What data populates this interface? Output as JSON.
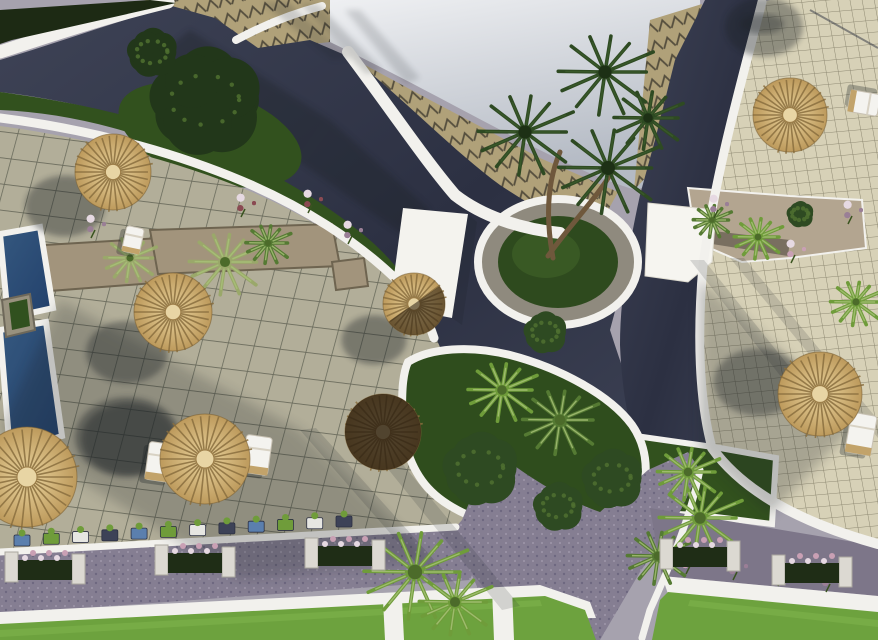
{
  "scene": {
    "description": "Aerial top-down 3D architectural rendering of a resort courtyard: dark blue-grey roads, beige tiled terraces with grid pavers, zigzag-patterned plaza, swimming pool at left edge, round and rectangular green planters with palm trees, straw parasols with sun loungers, white curved boundary walls, flower planter rows along a lower walkway and bright green lawns at the bottom",
    "sunlight": "hard daylight; soft shadows cast toward the lower left",
    "palette": {
      "roof1": "#f2f3f5",
      "roof2": "#b4bac4",
      "roadDark": "#3e4356",
      "roadDarker": "#2c3042",
      "roadLight": "#8a8496",
      "walkway": "#857e92",
      "gravel": "#7d7689",
      "zigBase": "#b0a179",
      "zigLine": "#564f3e",
      "terraceL": "#b2ae99",
      "terraceR": "#d7d1b7",
      "gridL": "#2d3228",
      "gridR": "#46422e",
      "white": "#f2f1ed",
      "grassDark": "#32511e",
      "lawn": "#6da23e",
      "lawnLight": "#7fb24c",
      "pool1": "#35587f",
      "pool2": "#22406b",
      "straw1": "#ead49e",
      "straw2": "#bd9a5c",
      "strawLine": "#8a6f3f",
      "palmDark": "#2e4a22",
      "palmMid": "#557a33",
      "palmLight": "#6f9c3a",
      "palmSage": "#9aa86a",
      "treeDark": "#22371a",
      "trunk": "#6f583c",
      "stone": "#a2947c",
      "flowerPink": "#c9a0b4",
      "flowerMauve": "#9a7f96",
      "flowerRed": "#8a4a52",
      "shadow": "#1c2026"
    }
  },
  "objects": {
    "parasols": [
      {
        "id": "parasol-1",
        "x": 113,
        "y": 172,
        "r": 38,
        "variant": "straw",
        "shadow": {
          "dx": -48,
          "dy": 34
        }
      },
      {
        "id": "parasol-2",
        "x": 27,
        "y": 477,
        "r": 50,
        "variant": "straw",
        "shadow": {
          "dx": 100,
          "dy": -40
        }
      },
      {
        "id": "parasol-3",
        "x": 173,
        "y": 312,
        "r": 39,
        "variant": "straw",
        "shadow": {
          "dx": -46,
          "dy": 40
        }
      },
      {
        "id": "parasol-4",
        "x": 205,
        "y": 459,
        "r": 45,
        "variant": "straw",
        "shadow": {
          "dx": -76,
          "dy": -20
        }
      },
      {
        "id": "parasol-5",
        "x": 383,
        "y": 432,
        "r": 38,
        "variant": "dark",
        "shadow": {
          "dx": 0,
          "dy": 0
        }
      },
      {
        "id": "parasol-6",
        "x": 414,
        "y": 304,
        "r": 31,
        "variant": "halfdark",
        "shadow": {
          "dx": -40,
          "dy": 36
        }
      },
      {
        "id": "parasol-7",
        "x": 790,
        "y": 115,
        "r": 37,
        "variant": "straw",
        "shadow": {
          "dx": -26,
          "dy": -88
        }
      },
      {
        "id": "parasol-8",
        "x": 820,
        "y": 394,
        "r": 42,
        "variant": "straw",
        "shadow": {
          "dx": -62,
          "dy": -12
        }
      }
    ],
    "loungers": [
      {
        "x": 160,
        "y": 462,
        "w": 26,
        "h": 38,
        "rot": 8
      },
      {
        "x": 257,
        "y": 455,
        "w": 26,
        "h": 38,
        "rot": 8
      },
      {
        "x": 861,
        "y": 434,
        "w": 26,
        "h": 40,
        "rot": 10
      },
      {
        "x": 864,
        "y": 103,
        "w": 22,
        "h": 30,
        "rot": 100
      },
      {
        "x": 133,
        "y": 240,
        "w": 18,
        "h": 26,
        "rot": 12
      },
      {
        "x": 12,
        "y": 495,
        "w": 18,
        "h": 28,
        "rot": 10
      }
    ],
    "palm_trees": [
      {
        "x": 525,
        "y": 132,
        "r": 55,
        "tone": "dark"
      },
      {
        "x": 608,
        "y": 168,
        "r": 58,
        "tone": "dark"
      },
      {
        "x": 605,
        "y": 72,
        "r": 55,
        "tone": "dark"
      },
      {
        "x": 648,
        "y": 118,
        "r": 40,
        "tone": "dark"
      },
      {
        "x": 415,
        "y": 572,
        "r": 60,
        "tone": "light"
      },
      {
        "x": 455,
        "y": 602,
        "r": 42,
        "tone": "light"
      },
      {
        "x": 700,
        "y": 518,
        "r": 48,
        "tone": "light"
      },
      {
        "x": 658,
        "y": 556,
        "r": 36,
        "tone": "mid"
      },
      {
        "x": 688,
        "y": 472,
        "r": 36,
        "tone": "light"
      },
      {
        "x": 225,
        "y": 262,
        "r": 42,
        "tone": "sage"
      },
      {
        "x": 130,
        "y": 258,
        "r": 30,
        "tone": "sage"
      },
      {
        "x": 268,
        "y": 243,
        "r": 26,
        "tone": "mid"
      },
      {
        "x": 712,
        "y": 220,
        "r": 22,
        "tone": "mid"
      },
      {
        "x": 758,
        "y": 237,
        "r": 28,
        "tone": "light"
      },
      {
        "x": 502,
        "y": 390,
        "r": 40,
        "tone": "light"
      },
      {
        "x": 560,
        "y": 420,
        "r": 44,
        "tone": "mid"
      },
      {
        "x": 856,
        "y": 302,
        "r": 30,
        "tone": "light"
      }
    ],
    "bushes": [
      {
        "x": 205,
        "y": 100,
        "r": 62,
        "tone": "tree"
      },
      {
        "x": 152,
        "y": 52,
        "r": 28,
        "tone": "tree"
      },
      {
        "x": 480,
        "y": 468,
        "r": 42,
        "tone": "dark"
      },
      {
        "x": 612,
        "y": 478,
        "r": 34,
        "tone": "dark"
      },
      {
        "x": 558,
        "y": 506,
        "r": 28,
        "tone": "dark"
      },
      {
        "x": 800,
        "y": 214,
        "r": 15,
        "tone": "dark"
      },
      {
        "x": 545,
        "y": 332,
        "r": 24,
        "tone": "dark"
      }
    ],
    "flower_clusters": [
      {
        "x": 95,
        "y": 224,
        "tone": "mauve"
      },
      {
        "x": 312,
        "y": 199,
        "tone": "red"
      },
      {
        "x": 352,
        "y": 230,
        "tone": "mauve"
      },
      {
        "x": 718,
        "y": 204,
        "tone": "mauve"
      },
      {
        "x": 795,
        "y": 249,
        "tone": "pink"
      },
      {
        "x": 852,
        "y": 210,
        "tone": "mauve"
      },
      {
        "x": 690,
        "y": 560,
        "tone": "pink"
      },
      {
        "x": 737,
        "y": 566,
        "tone": "mauve"
      },
      {
        "x": 782,
        "y": 572,
        "tone": "pink"
      },
      {
        "x": 830,
        "y": 578,
        "tone": "mauve"
      },
      {
        "x": 245,
        "y": 203,
        "tone": "red"
      }
    ],
    "mini_planters": {
      "start": [
        22,
        540
      ],
      "end": [
        344,
        521
      ],
      "count": 12,
      "colors": [
        "#5b7fae",
        "#6f9c3a",
        "#e6e6e2",
        "#3d4257"
      ]
    },
    "walkway_planters": [
      {
        "x": 45,
        "y": 566
      },
      {
        "x": 195,
        "y": 559
      },
      {
        "x": 345,
        "y": 552
      },
      {
        "x": 700,
        "y": 553
      },
      {
        "x": 812,
        "y": 569
      }
    ],
    "pools": [
      {
        "points": "0,234 40,227 53,308 8,318"
      },
      {
        "points": "0,330 46,322 62,436 10,452"
      }
    ],
    "spa": {
      "outer": "2,300 30,294 35,330 6,337",
      "inner": "9,303 27,299 30,326 12,330"
    }
  },
  "counts": {
    "parasols": 8,
    "sun_loungers": 6,
    "pools": 2,
    "walkway_planter_modules": 5
  }
}
